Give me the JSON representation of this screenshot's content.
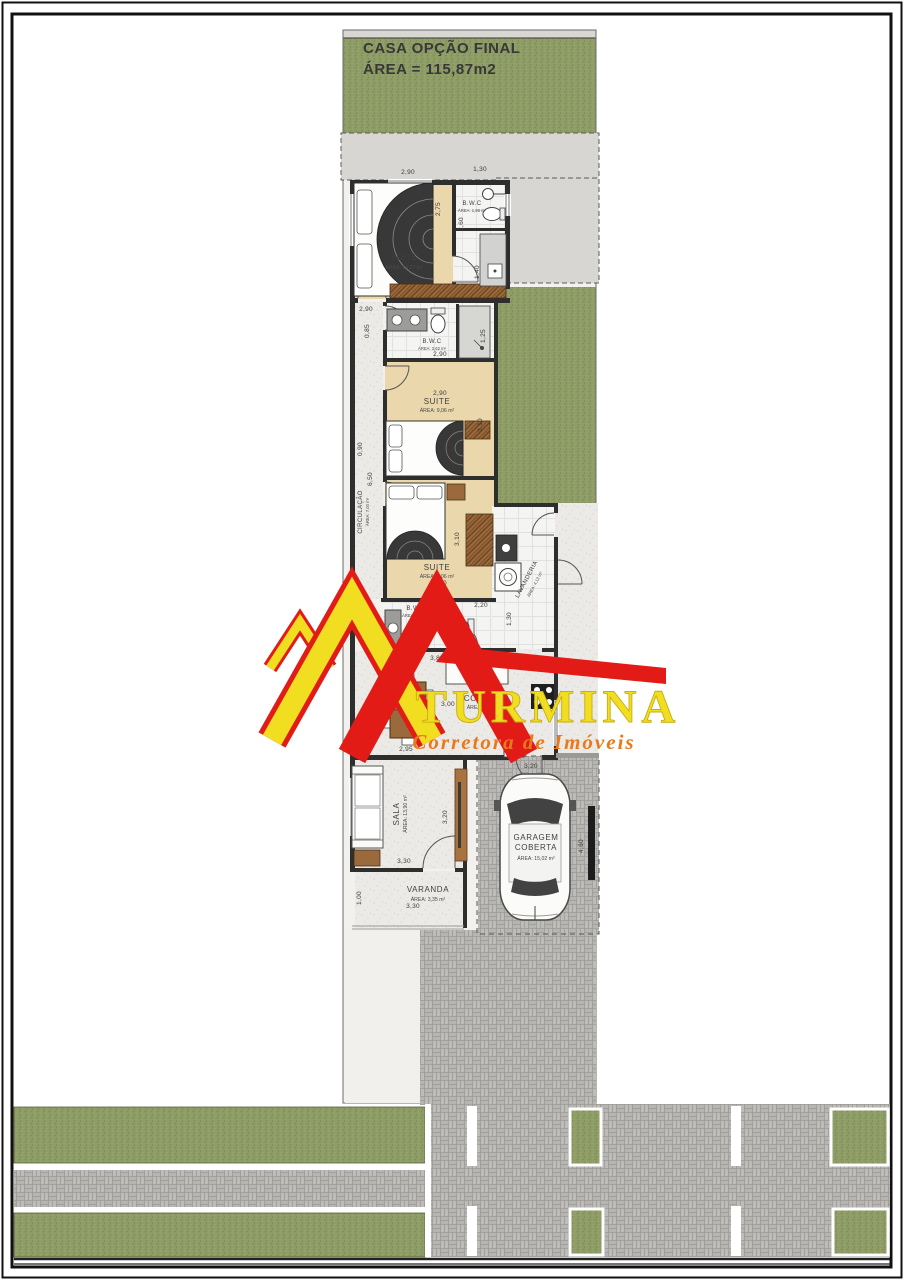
{
  "title": {
    "line1": "CASA OPÇÃO FINAL",
    "line2": "ÁREA = 115,87m2"
  },
  "watermark": {
    "name": "TURMINA",
    "tagline": "Corretora de Imóveis",
    "red": "#e31b17",
    "yellow": "#f2de20",
    "orange": "#e8791d"
  },
  "rooms": {
    "suite1": {
      "name": "SUITE",
      "area": "ÁREA: 14,27 m²"
    },
    "bwc1": {
      "name": "B.W.C",
      "area": "ÁREA: 1,98 m²"
    },
    "bwc2": {
      "name": "B.W.C",
      "area": "ÁREA: 3,62 m²"
    },
    "suite2": {
      "name": "SUITE",
      "area": "ÁREA: 9,06 m²"
    },
    "circulacao": {
      "name": "CIRCULAÇÃO",
      "area": "ÁREA: 7,00 m²"
    },
    "suite3": {
      "name": "SUITE",
      "area": "ÁREA: 9,06 m²"
    },
    "lavanderia": {
      "name": "LAVANDERIA",
      "area": "ÁREA: 4,13 m²"
    },
    "bwc3": {
      "name": "B.W.C",
      "area": "ÁREA: 2,04 m²"
    },
    "jantar": {
      "name": "JANTAR",
      "area": "ÁREA: 5,95 m²"
    },
    "cozinha": {
      "name": "COZINHA",
      "area": "ÁREA: 8,21 m²"
    },
    "sala": {
      "name": "SALA",
      "area": "ÁREA: 13,90 m²"
    },
    "varanda": {
      "name": "VARANDA",
      "area": "ÁREA: 3,35 m²"
    },
    "garagem": {
      "name1": "GARAGEM",
      "name2": "COBERTA",
      "area": "ÁREA: 15,02 m²"
    }
  },
  "dimensions": {
    "suite1_w": "2,90",
    "bwc1_w": "1,30",
    "suite1_h": "2,75",
    "bwc1_h": "2,60",
    "suite1_wb": "2,95",
    "bwc1_hb": "1,40",
    "circ_top": "2,90",
    "circ_top2": "0,85",
    "bwc2_w": "2,90",
    "bwc2_h": "1,25",
    "suite2_w": "2,90",
    "suite2_h": "3,10",
    "circ_w": "0,90",
    "circ_h": "6,50",
    "suite3_h": "3,10",
    "suite3_w": "2,90",
    "bwc3_w": "2,20",
    "lav_h": "1,30",
    "social_w": "3,80",
    "jantar_h": "3,00",
    "cozinha_w": "2,65",
    "jantar_w": "2,95",
    "garagem_w": "3,20",
    "garagem_h": "4,60",
    "sala_w": "3,30",
    "sala_h": "3,20",
    "varanda_h": "1,00",
    "varanda_w": "3,30"
  },
  "colors": {
    "grass": "#8e9c66",
    "paver": "#b6b5b2",
    "wall": "#2e2e2e",
    "suite_floor": "#ead7ab",
    "wood": "#9a6a3c"
  }
}
